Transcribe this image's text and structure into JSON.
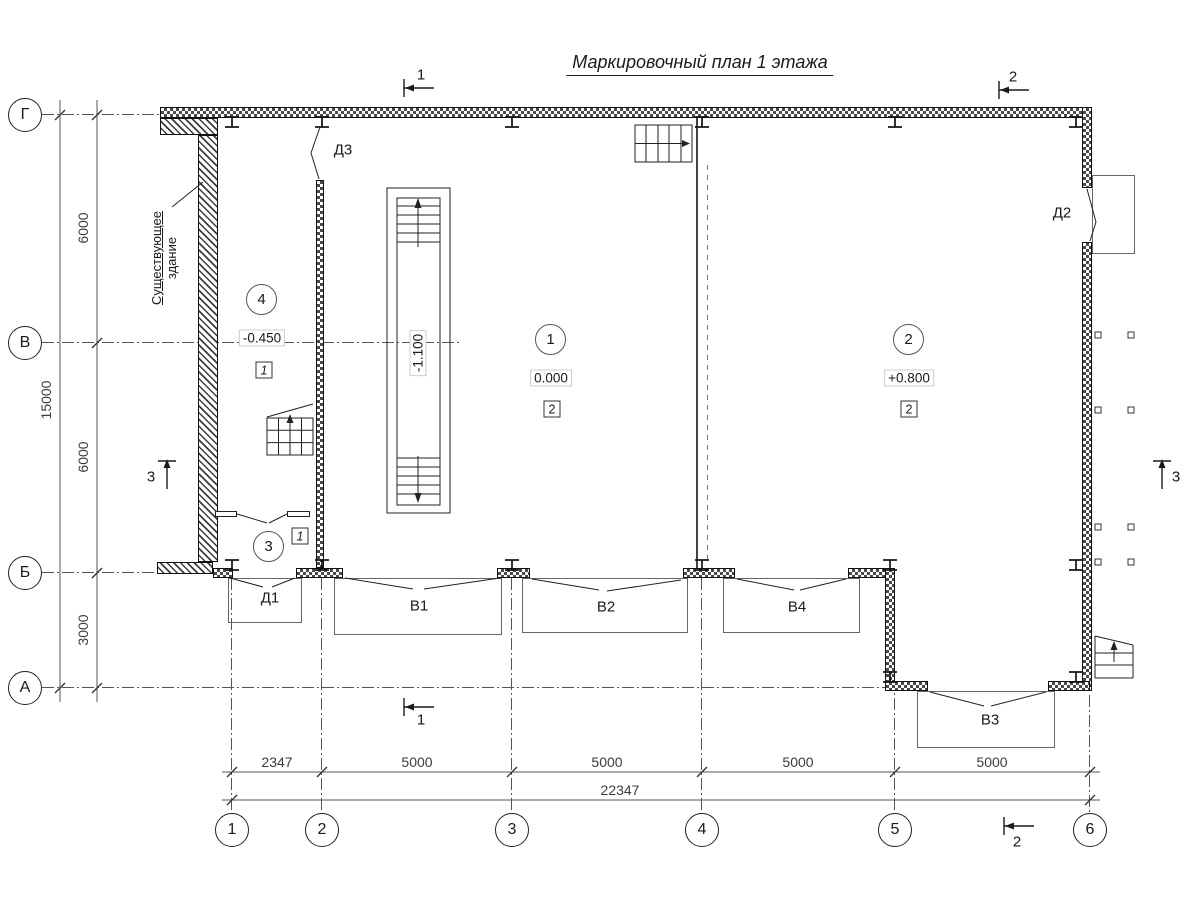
{
  "title": "Маркировочный план 1 этажа",
  "existing_building": {
    "line1": "Существующее",
    "line2": "здание"
  },
  "axes": {
    "rows": [
      {
        "label": "Г"
      },
      {
        "label": "В"
      },
      {
        "label": "Б"
      },
      {
        "label": "А"
      }
    ],
    "cols": [
      {
        "label": "1"
      },
      {
        "label": "2"
      },
      {
        "label": "3"
      },
      {
        "label": "4"
      },
      {
        "label": "5"
      },
      {
        "label": "6"
      }
    ]
  },
  "dimensions": {
    "left": {
      "segments": [
        "6000",
        "6000",
        "3000"
      ],
      "total": "15000"
    },
    "bottom": {
      "segments": [
        "2347",
        "5000",
        "5000",
        "5000",
        "5000"
      ],
      "total": "22347"
    }
  },
  "rooms": [
    {
      "number": "4",
      "level": "-0.450",
      "floor_type": "1"
    },
    {
      "number": "1",
      "level": "0.000",
      "floor_type": "2"
    },
    {
      "number": "2",
      "level": "+0.800",
      "floor_type": "2"
    },
    {
      "number": "3",
      "floor_type": "1"
    }
  ],
  "pit_level": "-1.100",
  "doors": [
    {
      "label": "Д1"
    },
    {
      "label": "Д2"
    },
    {
      "label": "Д3"
    }
  ],
  "windows": [
    {
      "label": "В1"
    },
    {
      "label": "В2"
    },
    {
      "label": "В3"
    },
    {
      "label": "В4"
    }
  ],
  "sections": [
    {
      "label": "1"
    },
    {
      "label": "2"
    },
    {
      "label": "3"
    }
  ],
  "colors": {
    "line": "#1a1a1a",
    "dim": "#3c3c3c"
  }
}
